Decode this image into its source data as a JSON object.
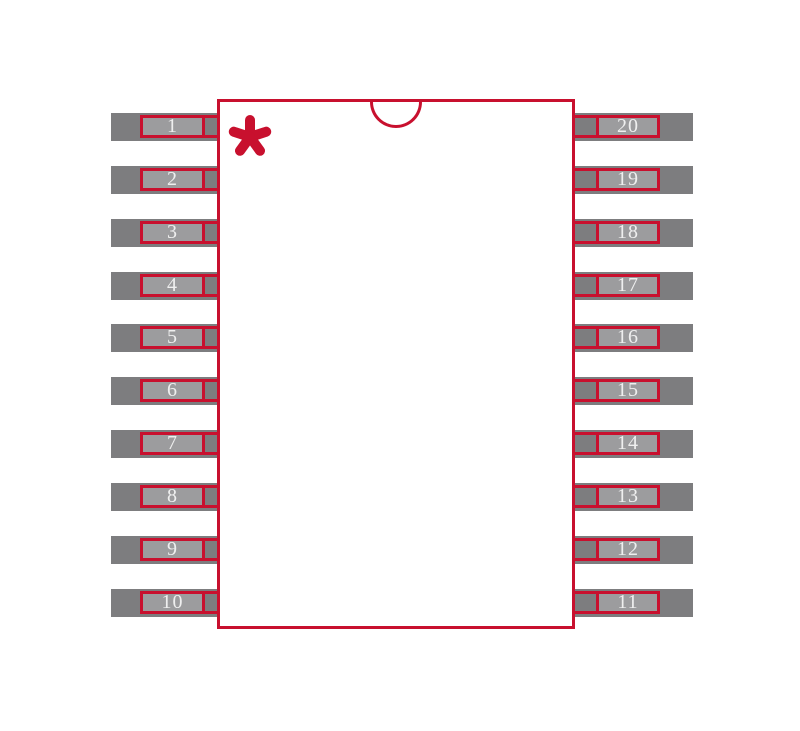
{
  "diagram": {
    "kind": "ic-package-footprint",
    "pin_count": 20,
    "orientation_notch": "top-center-semicircle",
    "pin1_marker_glyph": "*"
  },
  "pins": {
    "left": [
      "1",
      "2",
      "3",
      "4",
      "5",
      "6",
      "7",
      "8",
      "9",
      "10"
    ],
    "right": [
      "20",
      "19",
      "18",
      "17",
      "16",
      "15",
      "14",
      "13",
      "12",
      "11"
    ]
  },
  "colors": {
    "red": "#c8102e",
    "pad_dark": "#7d7d7f",
    "pad_light": "#9c9c9e",
    "background": "#ffffff",
    "pin_number_text": "#efefef"
  }
}
